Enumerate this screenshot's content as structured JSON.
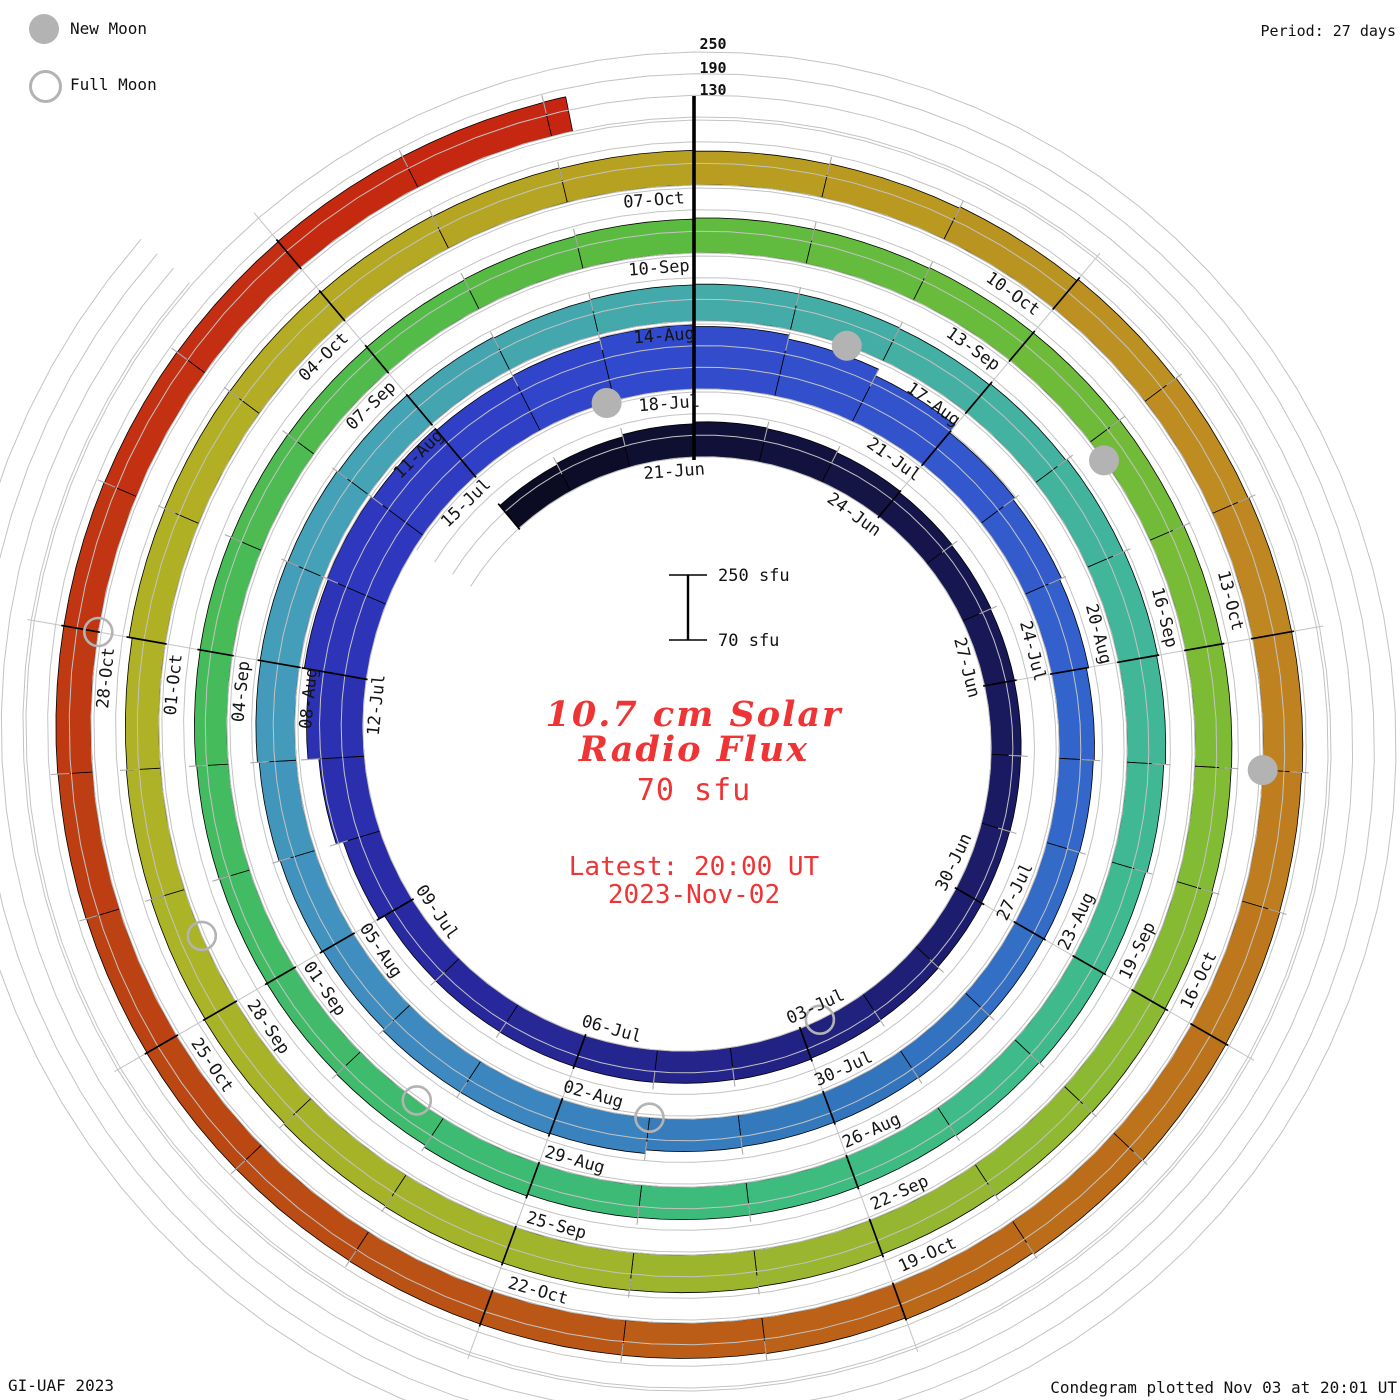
{
  "legend": {
    "new_moon_label": "New Moon",
    "full_moon_label": "Full Moon"
  },
  "header": {
    "period_label": "Period: 27 days",
    "grid_value_labels": [
      "250",
      "190",
      "130"
    ]
  },
  "footer": {
    "credit_left": "GI-UAF 2023",
    "credit_right": "Condegram plotted Nov 03 at 20:01 UT"
  },
  "center": {
    "title_line1": "10.7 cm Solar",
    "title_line2": "Radio Flux",
    "current_value": "70 sfu",
    "latest_line1": "Latest: 20:00 UT",
    "latest_line2": "2023-Nov-02",
    "scale_top_label": "250 sfu",
    "scale_bottom_label": "70 sfu",
    "accent_color": "#ee3434"
  },
  "chart_data": {
    "type": "spiral-bar-condegram",
    "title": "10.7 cm Solar Radio Flux",
    "units": "sfu",
    "period_days": 27,
    "flux_baseline_sfu": 70,
    "flux_max_sfu": 250,
    "grid_levels_sfu": [
      70,
      130,
      190,
      250
    ],
    "start_date": "2023-06-18",
    "end_date": "2023-11-02",
    "day_index_of_first_value": -3,
    "end_day": 134.15,
    "daily_flux_sfu": [
      152,
      156,
      162,
      167,
      165,
      162,
      158,
      156,
      154,
      153,
      152,
      151,
      153,
      156,
      158,
      160,
      159,
      160,
      161,
      160,
      159,
      176,
      196,
      226,
      244,
      248,
      242,
      236,
      240,
      248,
      243,
      232,
      212,
      186,
      180,
      174,
      168,
      165,
      163,
      161,
      160,
      159,
      158,
      160,
      170,
      172,
      172,
      167,
      170,
      173,
      178,
      180,
      178,
      175,
      171,
      168,
      170,
      172,
      172,
      170,
      174,
      178,
      180,
      177,
      172,
      168,
      165,
      162,
      160,
      160,
      160,
      161,
      166,
      160,
      158,
      157,
      158,
      160,
      161,
      160,
      159,
      160,
      162,
      164,
      167,
      168,
      170,
      170,
      171,
      172,
      172,
      171,
      173,
      175,
      173,
      170,
      172,
      174,
      175,
      175,
      173,
      170,
      167,
      165,
      163,
      172,
      173,
      172,
      170,
      168,
      166,
      164,
      166,
      170,
      175,
      178,
      180,
      180,
      178,
      179,
      180,
      178,
      174,
      170,
      168,
      167,
      167,
      166,
      166,
      165,
      166,
      167,
      167,
      166,
      165,
      166,
      166,
      167
    ],
    "date_labels": [
      {
        "t": "21-Jun",
        "d": 0
      },
      {
        "t": "24-Jun",
        "d": 3
      },
      {
        "t": "27-Jun",
        "d": 6
      },
      {
        "t": "30-Jun",
        "d": 9
      },
      {
        "t": "03-Jul",
        "d": 12
      },
      {
        "t": "06-Jul",
        "d": 15
      },
      {
        "t": "09-Jul",
        "d": 18
      },
      {
        "t": "12-Jul",
        "d": 21
      },
      {
        "t": "15-Jul",
        "d": 24
      },
      {
        "t": "18-Jul",
        "d": 27
      },
      {
        "t": "21-Jul",
        "d": 30
      },
      {
        "t": "24-Jul",
        "d": 33
      },
      {
        "t": "27-Jul",
        "d": 36
      },
      {
        "t": "30-Jul",
        "d": 39
      },
      {
        "t": "02-Aug",
        "d": 42
      },
      {
        "t": "05-Aug",
        "d": 45
      },
      {
        "t": "08-Aug",
        "d": 48
      },
      {
        "t": "11-Aug",
        "d": 51
      },
      {
        "t": "14-Aug",
        "d": 54
      },
      {
        "t": "17-Aug",
        "d": 57
      },
      {
        "t": "20-Aug",
        "d": 60
      },
      {
        "t": "23-Aug",
        "d": 63
      },
      {
        "t": "26-Aug",
        "d": 66
      },
      {
        "t": "29-Aug",
        "d": 69
      },
      {
        "t": "01-Sep",
        "d": 72
      },
      {
        "t": "04-Sep",
        "d": 75
      },
      {
        "t": "07-Sep",
        "d": 78
      },
      {
        "t": "10-Sep",
        "d": 81
      },
      {
        "t": "13-Sep",
        "d": 84
      },
      {
        "t": "16-Sep",
        "d": 87
      },
      {
        "t": "19-Sep",
        "d": 90
      },
      {
        "t": "22-Sep",
        "d": 93
      },
      {
        "t": "25-Sep",
        "d": 96
      },
      {
        "t": "28-Sep",
        "d": 99
      },
      {
        "t": "01-Oct",
        "d": 102
      },
      {
        "t": "04-Oct",
        "d": 105
      },
      {
        "t": "07-Oct",
        "d": 108
      },
      {
        "t": "10-Oct",
        "d": 111
      },
      {
        "t": "13-Oct",
        "d": 114
      },
      {
        "t": "16-Oct",
        "d": 117
      },
      {
        "t": "19-Oct",
        "d": 120
      },
      {
        "t": "22-Oct",
        "d": 123
      },
      {
        "t": "25-Oct",
        "d": 126
      },
      {
        "t": "28-Oct",
        "d": 129
      }
    ],
    "new_moon_days": [
      25.9,
      55.6,
      85.2,
      115.0
    ],
    "full_moon_days": [
      11.7,
      41.0,
      70.3,
      99.6,
      129.0
    ],
    "colormap_stops": [
      [
        -3,
        "#0a0a20"
      ],
      [
        2,
        "#131342"
      ],
      [
        8,
        "#1b1b66"
      ],
      [
        13,
        "#232388"
      ],
      [
        18,
        "#2a2aa4"
      ],
      [
        22,
        "#2d35bb"
      ],
      [
        26,
        "#3147cc"
      ],
      [
        30,
        "#3355cc"
      ],
      [
        34,
        "#3366cc"
      ],
      [
        39,
        "#3377bb"
      ],
      [
        44,
        "#3f8cc0"
      ],
      [
        49,
        "#44a0b8"
      ],
      [
        54,
        "#44aaaa"
      ],
      [
        59,
        "#42b59c"
      ],
      [
        64,
        "#3ebb8a"
      ],
      [
        69,
        "#3dbb74"
      ],
      [
        74,
        "#44bb5e"
      ],
      [
        79,
        "#55bb44"
      ],
      [
        84,
        "#6abb3a"
      ],
      [
        89,
        "#85bb33"
      ],
      [
        94,
        "#9cb42e"
      ],
      [
        99,
        "#aab327"
      ],
      [
        104,
        "#b3ae24"
      ],
      [
        109,
        "#b89b20"
      ],
      [
        114,
        "#c08522"
      ],
      [
        118,
        "#bb701a"
      ],
      [
        122,
        "#bb5a16"
      ],
      [
        126,
        "#bb4413"
      ],
      [
        130,
        "#c23312"
      ],
      [
        134,
        "#c62511"
      ]
    ],
    "grid_color": "#c3c3c3",
    "day_tick_color": "#ababab",
    "moon_color": "#b3b3b3",
    "layout": {
      "cx": 694,
      "cy": 737,
      "r0": 280,
      "r_per_rev": 68,
      "px_per_scale": 65
    }
  }
}
